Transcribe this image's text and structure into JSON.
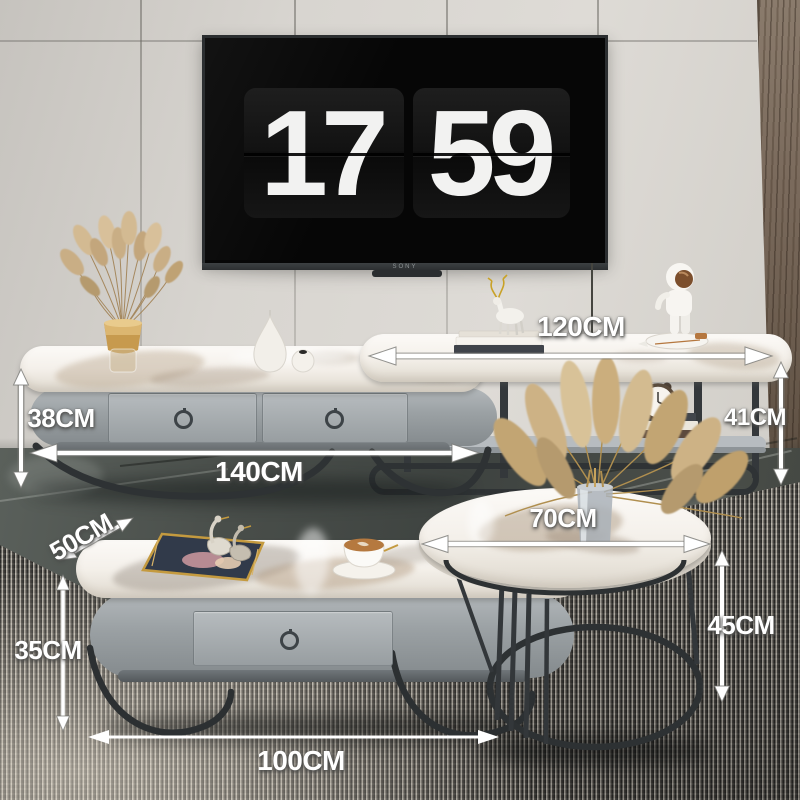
{
  "tv": {
    "brand": "SONY",
    "clock": {
      "hours": "17",
      "minutes": "59"
    }
  },
  "dimensions": {
    "tv_stand": {
      "height": "38CM",
      "width": "140CM"
    },
    "console": {
      "width": "120CM",
      "height": "41CM"
    },
    "coffee_table": {
      "depth": "50CM",
      "height": "35CM",
      "width": "100CM"
    },
    "round_table": {
      "diameter": "70CM",
      "height": "45CM"
    }
  },
  "palette": {
    "wall": "#d8d5d0",
    "wood_panel": "#7a6a5c",
    "floor_marble": "#464b47",
    "rug_light": "#bcb7ad",
    "rug_dark": "#3a3834",
    "furniture_gray": "#9aa0a3",
    "marble_top": "#f4f0ea",
    "metal_frame": "#33373a",
    "accent_gold": "#c9a24b",
    "annotation_text": "#ffffff"
  }
}
